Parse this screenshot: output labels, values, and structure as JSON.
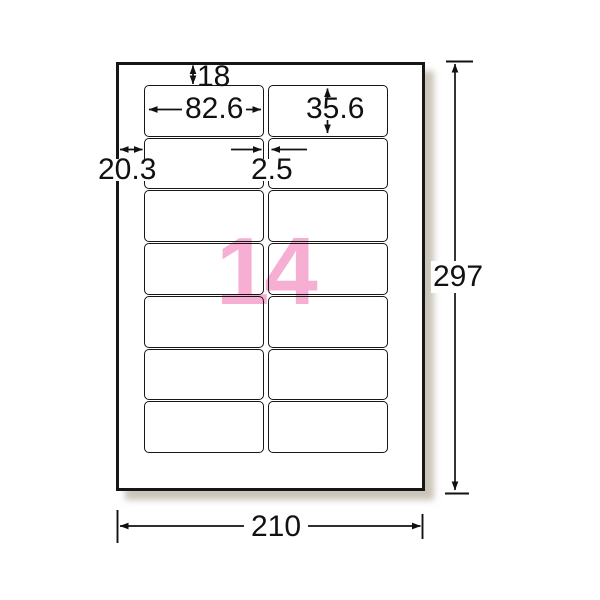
{
  "figure": {
    "title": "14-label sheet dimension diagram",
    "count_text": "14",
    "grid": {
      "rows": 7,
      "columns": 2
    },
    "dimensions": {
      "top_margin": "18",
      "label_width": "82.6",
      "label_height": "35.6",
      "left_margin": "20.3",
      "column_gap": "2.5",
      "sheet_height": "297",
      "sheet_width": "210"
    },
    "colors": {
      "line": "#111111",
      "paper": "#ffffff",
      "count_pink": "#f6aed3",
      "shadow": "#a09680"
    }
  }
}
